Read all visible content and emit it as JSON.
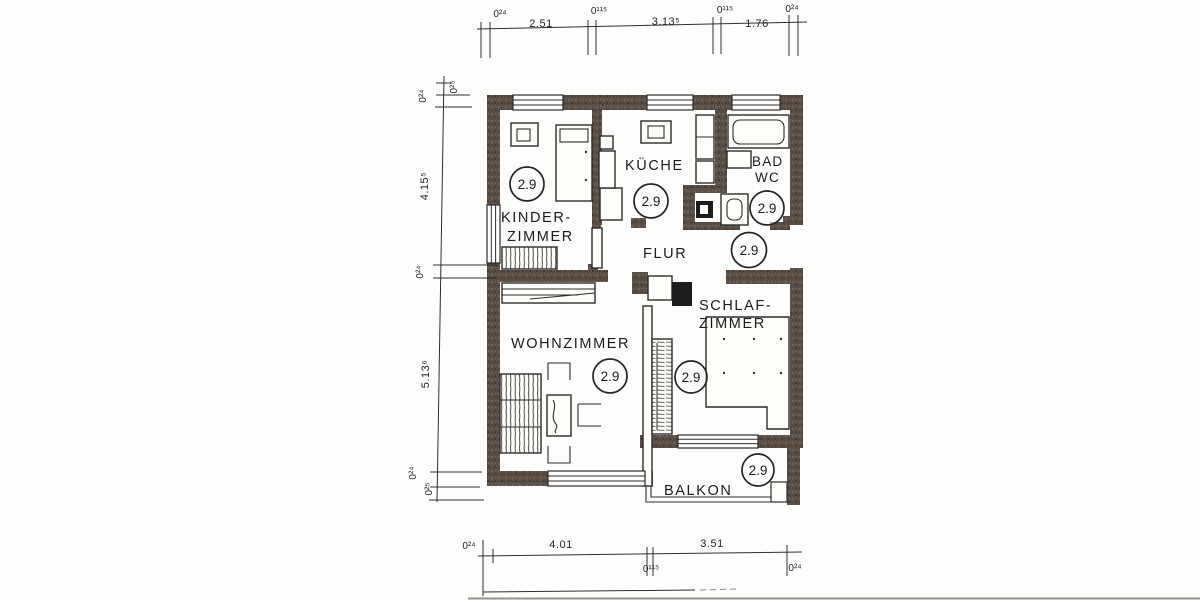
{
  "colors": {
    "wall": "#594e46",
    "line": "#2b2b2b",
    "paper": "#fdfdfc",
    "text": "#1b1b1b"
  },
  "rooms": {
    "kinderzimmer": {
      "label_line1": "KINDER-",
      "label_line2": "ZIMMER",
      "ceiling_height": "2.9"
    },
    "kueche": {
      "label": "KÜCHE",
      "ceiling_height": "2.9"
    },
    "bad_wc": {
      "label_line1": "BAD",
      "label_line2": "WC",
      "ceiling_height": "2.9"
    },
    "flur": {
      "label": "FLUR",
      "ceiling_height": "2.9"
    },
    "wohnzimmer": {
      "label": "WOHNZIMMER",
      "ceiling_height": "2.9"
    },
    "schlafzimmer": {
      "label_line1": "SCHLAF-",
      "label_line2": "ZIMMER",
      "ceiling_height": "2.9"
    },
    "balkon": {
      "label": "BALKON",
      "ceiling_height": "2.9"
    }
  },
  "dimensions": {
    "top": [
      "0²⁴",
      "2.51",
      "0¹¹⁵",
      "3.13⁵",
      "0¹¹⁵",
      "1.76",
      "0²⁴"
    ],
    "left": [
      "0²⁴",
      "0²⁵",
      "4.15⁵",
      "0²⁴",
      "5.13⁶",
      "0²⁴",
      "0²⁵"
    ],
    "bottom": [
      "0²⁴",
      "4.01",
      "0¹¹⁵",
      "3.51",
      "0²⁴"
    ]
  }
}
